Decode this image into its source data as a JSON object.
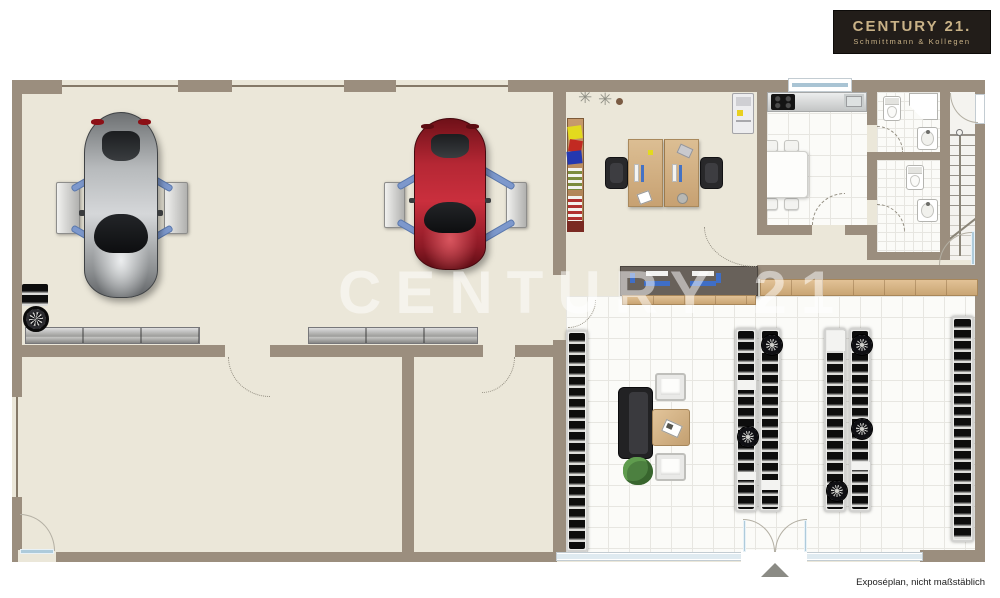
{
  "branding": {
    "logo_title": "CENTURY 21.",
    "logo_subtitle": "Schmittmann & Kollegen"
  },
  "watermark": {
    "text": "CENTURY 21"
  },
  "footer": {
    "caption": "Exposéplan, nicht maßstäblich"
  },
  "palette": {
    "wall": "#9b8e7e",
    "wall_dark": "#857968",
    "floor": "#ebe7d9",
    "tile": "#fbfbf8",
    "tile_line": "#e7e6e1",
    "wood": "#d7b78b",
    "counter_dark": "#68615a",
    "steel_blue": "#7d98cc",
    "car_red": "#b62836",
    "car_silver": "#b9bcbe",
    "glass": "#dfeaf0",
    "logo_bg": "#221d19",
    "logo_text": "#c9b287",
    "watermark_color": "rgba(255,255,255,0.5)"
  }
}
